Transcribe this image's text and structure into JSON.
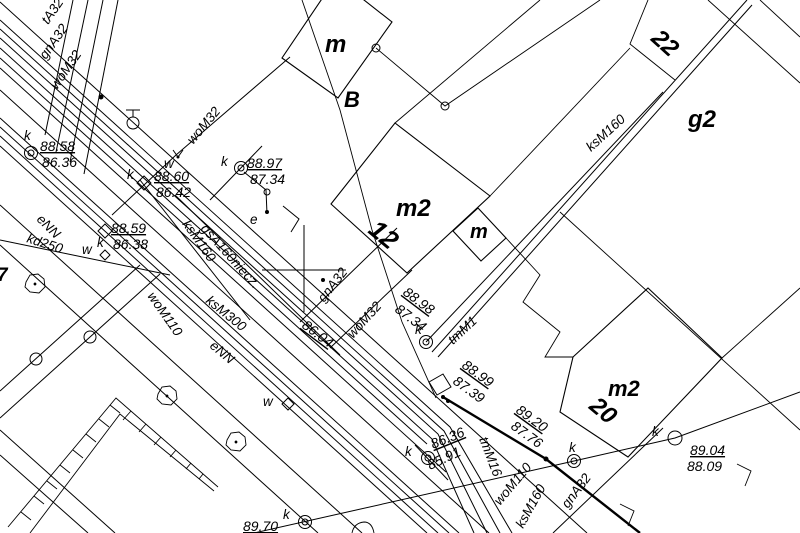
{
  "map": {
    "title": "cadastral-utility-survey-map",
    "background_color": "#ffffff",
    "line_color": "#000000"
  },
  "labels": [
    {
      "name": "parcel-label-m-top",
      "text": "m",
      "x": 325,
      "y": 52,
      "rot": 0,
      "size": 24,
      "bold": true,
      "underline": false
    },
    {
      "name": "parcel-label-B",
      "text": "B",
      "x": 344,
      "y": 107,
      "rot": 0,
      "size": 22,
      "bold": true,
      "underline": false
    },
    {
      "name": "building-label-m2-12",
      "text": "m2",
      "x": 396,
      "y": 216,
      "rot": 0,
      "size": 24,
      "bold": true,
      "underline": false
    },
    {
      "name": "house-number-12",
      "text": "12",
      "x": 367,
      "y": 232,
      "rot": 40,
      "size": 26,
      "bold": true,
      "underline": false
    },
    {
      "name": "building-label-m-small",
      "text": "m",
      "x": 470,
      "y": 238,
      "rot": 0,
      "size": 20,
      "bold": true,
      "underline": false
    },
    {
      "name": "house-number-22",
      "text": "22",
      "x": 650,
      "y": 40,
      "rot": 42,
      "size": 24,
      "bold": true,
      "underline": false
    },
    {
      "name": "parcel-label-g2",
      "text": "g2",
      "x": 688,
      "y": 127,
      "rot": 0,
      "size": 24,
      "bold": true,
      "underline": false
    },
    {
      "name": "building-label-m2-20",
      "text": "m2",
      "x": 608,
      "y": 396,
      "rot": 0,
      "size": 22,
      "bold": true,
      "underline": false
    },
    {
      "name": "house-number-20",
      "text": "20",
      "x": 588,
      "y": 408,
      "rot": 40,
      "size": 24,
      "bold": true,
      "underline": false
    },
    {
      "name": "parcel-label-7",
      "text": "7",
      "x": -3,
      "y": 281,
      "rot": 0,
      "size": 19,
      "bold": true,
      "underline": false
    },
    {
      "name": "spot-elevation-a-top",
      "text": "88.58",
      "x": 40,
      "y": 151,
      "rot": 0,
      "size": 14,
      "bold": false,
      "underline": true
    },
    {
      "name": "spot-elevation-a-bottom",
      "text": "86.36",
      "x": 42,
      "y": 167,
      "rot": 0,
      "size": 14,
      "bold": false,
      "underline": false
    },
    {
      "name": "spot-elevation-b-top",
      "text": "88.60",
      "x": 154,
      "y": 181,
      "rot": 0,
      "size": 14,
      "bold": false,
      "underline": true
    },
    {
      "name": "spot-elevation-b-bottom",
      "text": "86.42",
      "x": 156,
      "y": 197,
      "rot": 0,
      "size": 14,
      "bold": false,
      "underline": false
    },
    {
      "name": "spot-elevation-c-top",
      "text": "88.97",
      "x": 247,
      "y": 168,
      "rot": 0,
      "size": 14,
      "bold": false,
      "underline": true
    },
    {
      "name": "spot-elevation-c-bottom",
      "text": "87.34",
      "x": 250,
      "y": 184,
      "rot": 0,
      "size": 14,
      "bold": false,
      "underline": false
    },
    {
      "name": "spot-elevation-d-top",
      "text": "88.59",
      "x": 111,
      "y": 233,
      "rot": 0,
      "size": 14,
      "bold": false,
      "underline": true
    },
    {
      "name": "spot-elevation-d-bottom",
      "text": "86.38",
      "x": 113,
      "y": 249,
      "rot": 0,
      "size": 14,
      "bold": false,
      "underline": false
    },
    {
      "name": "spot-elevation-e-top",
      "text": "88.98",
      "x": 402,
      "y": 294,
      "rot": 37,
      "size": 14,
      "bold": false,
      "underline": true
    },
    {
      "name": "spot-elevation-e-bottom",
      "text": "87.34",
      "x": 394,
      "y": 311,
      "rot": 37,
      "size": 14,
      "bold": false,
      "underline": false
    },
    {
      "name": "spot-elevation-f",
      "text": "86.04",
      "x": 301,
      "y": 327,
      "rot": 37,
      "size": 14,
      "bold": false,
      "underline": true
    },
    {
      "name": "spot-elevation-g-top",
      "text": "88.99",
      "x": 461,
      "y": 367,
      "rot": 36,
      "size": 14,
      "bold": false,
      "underline": true
    },
    {
      "name": "spot-elevation-g-bottom",
      "text": "87.39",
      "x": 452,
      "y": 383,
      "rot": 36,
      "size": 14,
      "bold": false,
      "underline": false
    },
    {
      "name": "spot-elevation-h-top",
      "text": "89.20",
      "x": 515,
      "y": 412,
      "rot": 36,
      "size": 14,
      "bold": false,
      "underline": true
    },
    {
      "name": "spot-elevation-h-bottom",
      "text": "87.76",
      "x": 510,
      "y": 428,
      "rot": 36,
      "size": 14,
      "bold": false,
      "underline": false
    },
    {
      "name": "spot-elevation-i-top",
      "text": "86.36",
      "x": 433,
      "y": 449,
      "rot": -22,
      "size": 14,
      "bold": false,
      "underline": true
    },
    {
      "name": "spot-elevation-i-bottom",
      "text": "85.91",
      "x": 430,
      "y": 470,
      "rot": -25,
      "size": 14,
      "bold": false,
      "underline": false
    },
    {
      "name": "spot-elevation-j-top",
      "text": "89.04",
      "x": 690,
      "y": 455,
      "rot": 0,
      "size": 14,
      "bold": false,
      "underline": true
    },
    {
      "name": "spot-elevation-j-bottom",
      "text": "88.09",
      "x": 687,
      "y": 471,
      "rot": 0,
      "size": 14,
      "bold": false,
      "underline": false
    },
    {
      "name": "spot-elevation-partial",
      "text": "89.70",
      "x": 243,
      "y": 531,
      "rot": 0,
      "size": 14,
      "bold": false,
      "underline": true
    },
    {
      "name": "utility-label-tA32",
      "text": "tA32",
      "x": 48,
      "y": 25,
      "rot": -55,
      "size": 13.5,
      "bold": false,
      "underline": false
    },
    {
      "name": "utility-label-gnA32-topleft",
      "text": "gnA32",
      "x": 46,
      "y": 60,
      "rot": -55,
      "size": 13.5,
      "bold": false,
      "underline": false
    },
    {
      "name": "utility-label-woM32-topleft",
      "text": "woM32",
      "x": 57,
      "y": 90,
      "rot": -55,
      "size": 13.5,
      "bold": false,
      "underline": false
    },
    {
      "name": "utility-label-woM32-mid",
      "text": "woM32",
      "x": 193,
      "y": 145,
      "rot": -50,
      "size": 13.5,
      "bold": false,
      "underline": false
    },
    {
      "name": "utility-label-woM32-center",
      "text": "woM32",
      "x": 353,
      "y": 339,
      "rot": -48,
      "size": 13.5,
      "bold": false,
      "underline": false
    },
    {
      "name": "utility-label-gnA32-center",
      "text": "gnA32",
      "x": 324,
      "y": 303,
      "rot": -52,
      "size": 13.5,
      "bold": false,
      "underline": false
    },
    {
      "name": "utility-label-woM110",
      "text": "woM110",
      "x": 147,
      "y": 296,
      "rot": 55,
      "size": 13.5,
      "bold": false,
      "underline": false
    },
    {
      "name": "utility-label-ksM300",
      "text": "ksM300",
      "x": 205,
      "y": 302,
      "rot": 39,
      "size": 13.5,
      "bold": false,
      "underline": false
    },
    {
      "name": "utility-label-eNN-road",
      "text": "eNN",
      "x": 209,
      "y": 347,
      "rot": 40,
      "size": 13.5,
      "bold": false,
      "underline": false
    },
    {
      "name": "utility-label-eNN-left",
      "text": "eNN",
      "x": 36,
      "y": 220,
      "rot": 45,
      "size": 13.5,
      "bold": false,
      "underline": false
    },
    {
      "name": "utility-label-kd250",
      "text": "kd250",
      "x": 26,
      "y": 242,
      "rot": 18,
      "size": 13.5,
      "bold": false,
      "underline": false
    },
    {
      "name": "utility-label-ksM160-upper",
      "text": "ksM160",
      "x": 182,
      "y": 224,
      "rot": 55,
      "size": 13.5,
      "bold": false,
      "underline": false
    },
    {
      "name": "utility-label-gsA160niecz",
      "text": "gsA160niecz.",
      "x": 200,
      "y": 229,
      "rot": 48,
      "size": 13.5,
      "bold": false,
      "underline": false
    },
    {
      "name": "utility-label-ksM160-right",
      "text": "ksM160",
      "x": 591,
      "y": 152,
      "rot": -42,
      "size": 13.5,
      "bold": false,
      "underline": false
    },
    {
      "name": "utility-label-tmM1",
      "text": "tmM1",
      "x": 453,
      "y": 345,
      "rot": -43,
      "size": 13.5,
      "bold": false,
      "underline": false
    },
    {
      "name": "utility-label-tmM16",
      "text": "tmM16",
      "x": 479,
      "y": 439,
      "rot": 69,
      "size": 13.5,
      "bold": false,
      "underline": false
    },
    {
      "name": "utility-label-woM110-bottom",
      "text": "woM110",
      "x": 500,
      "y": 506,
      "rot": -50,
      "size": 13.5,
      "bold": false,
      "underline": false
    },
    {
      "name": "utility-label-ksM160-bottom",
      "text": "ksM160",
      "x": 523,
      "y": 529,
      "rot": -61,
      "size": 13.5,
      "bold": false,
      "underline": false
    },
    {
      "name": "utility-label-gnA32-bottom",
      "text": "gnA32",
      "x": 568,
      "y": 509,
      "rot": -53,
      "size": 13.5,
      "bold": false,
      "underline": false
    },
    {
      "name": "point-code-k-a",
      "text": "k",
      "x": 24,
      "y": 140,
      "rot": 0,
      "size": 13.5,
      "bold": false,
      "underline": false
    },
    {
      "name": "point-code-k-b",
      "text": "k",
      "x": 127,
      "y": 179,
      "rot": 0,
      "size": 13.5,
      "bold": false,
      "underline": false
    },
    {
      "name": "point-code-k-c",
      "text": "k",
      "x": 221,
      "y": 166,
      "rot": 0,
      "size": 13.5,
      "bold": false,
      "underline": false
    },
    {
      "name": "point-code-k-d",
      "text": "k",
      "x": 97,
      "y": 247,
      "rot": 0,
      "size": 13.5,
      "bold": false,
      "underline": false
    },
    {
      "name": "point-code-k-e",
      "text": "k",
      "x": 415,
      "y": 334,
      "rot": 0,
      "size": 13.5,
      "bold": false,
      "underline": false
    },
    {
      "name": "point-code-k-i",
      "text": "k",
      "x": 405,
      "y": 456,
      "rot": 0,
      "size": 13.5,
      "bold": false,
      "underline": false
    },
    {
      "name": "point-code-k-bottom",
      "text": "k",
      "x": 283,
      "y": 519,
      "rot": 0,
      "size": 13.5,
      "bold": false,
      "underline": false
    },
    {
      "name": "point-code-k-right",
      "text": "k",
      "x": 569,
      "y": 452,
      "rot": 0,
      "size": 13.5,
      "bold": false,
      "underline": false
    },
    {
      "name": "point-code-k-j",
      "text": "k",
      "x": 652,
      "y": 436,
      "rot": 0,
      "size": 13.5,
      "bold": false,
      "underline": false
    },
    {
      "name": "point-code-w-b",
      "text": "w",
      "x": 164,
      "y": 168,
      "rot": 0,
      "size": 13.5,
      "bold": false,
      "underline": false
    },
    {
      "name": "point-code-w-d",
      "text": "w",
      "x": 82,
      "y": 254,
      "rot": 0,
      "size": 13.5,
      "bold": false,
      "underline": false
    },
    {
      "name": "point-code-w-junction",
      "text": "w",
      "x": 263,
      "y": 406,
      "rot": 0,
      "size": 13.5,
      "bold": false,
      "underline": false
    },
    {
      "name": "point-code-e",
      "text": "e",
      "x": 250,
      "y": 224,
      "rot": 0,
      "size": 13.5,
      "bold": false,
      "underline": false
    }
  ]
}
